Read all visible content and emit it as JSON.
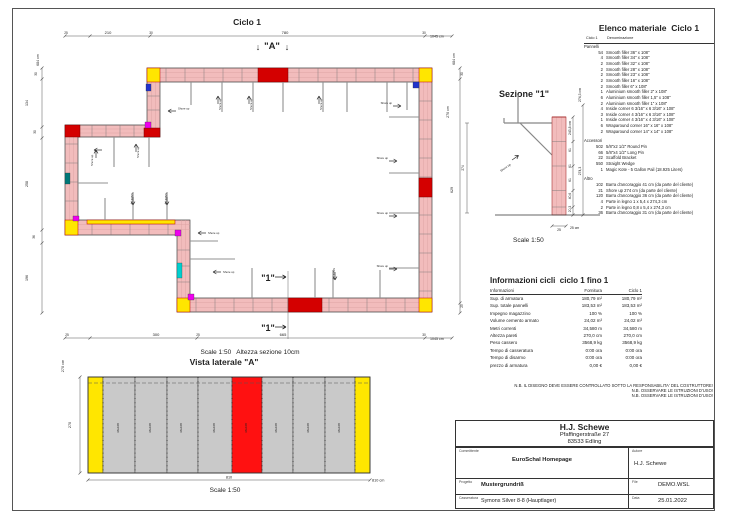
{
  "colors": {
    "wall": "#f2bcbc",
    "yellow": "#ffe600",
    "red": "#d40000",
    "vista_red": "#ff1111",
    "panel_gray": "#c9c9c9",
    "magenta": "#ee00ee",
    "cyan": "#00cfcf",
    "teal": "#007878",
    "blue": "#2233cc"
  },
  "plan": {
    "title": "Ciclo 1",
    "marker_a": "\"A\"",
    "marker_arrow_down": "↓",
    "marker_1": "\"1\"",
    "scale_note": "Scale 1:50   Altezza sezione 10cm",
    "shore_label": "Shore up",
    "dims": {
      "top": {
        "t1": "25",
        "s1": "210",
        "t2": "30",
        "s2": "780",
        "t3": "30",
        "total": "1045 cm"
      },
      "bottom": {
        "t1": "25",
        "s1": "300",
        "t2": "25",
        "s2": "665",
        "t3": "30",
        "total": "1045 cm"
      },
      "left": {
        "total": "684 cm",
        "segs": [
          "30",
          "134",
          "30",
          "258",
          "36",
          "196"
        ]
      },
      "right": {
        "total": "684 cm",
        "s1": "30",
        "s2": "629",
        "s3": "25",
        "aux": "270 cm",
        "aux2": "274"
      }
    }
  },
  "sezione": {
    "title": "Sezione \"1\"",
    "scale": "Scale 1:50",
    "shore_label": "Shore up",
    "dims": {
      "total_inner": "243,8 cm",
      "segs": [
        "61",
        "61",
        "61",
        "40,6",
        "20,3"
      ],
      "outer": "274,3",
      "outer_total": "274,3 cm",
      "base": "25",
      "base_cm": "25 cm"
    }
  },
  "vista": {
    "title": "Vista laterale \"A\"",
    "scale": "Scale 1:50",
    "panel_label": "36x108",
    "dims": {
      "h_total": "270 cm",
      "h": "270",
      "w": "810",
      "w_total": "810 cm"
    }
  },
  "materials": {
    "title": "Elenco materiale  Ciclo 1",
    "col_qty": "Ciclo 1",
    "col_name": "Denominazione",
    "group1": {
      "header": "Pannelli",
      "items": [
        {
          "qty": "54",
          "name": "Smooth filler 36\" x 108\""
        },
        {
          "qty": "4",
          "name": "Smooth filler 34\" x 108\""
        },
        {
          "qty": "2",
          "name": "Smooth filler 32\" x 108\""
        },
        {
          "qty": "2",
          "name": "Smooth filler 28\" x 108\""
        },
        {
          "qty": "2",
          "name": "Smooth filler 23\" x 108\""
        },
        {
          "qty": "2",
          "name": "Smooth filler 16\" x 108\""
        },
        {
          "qty": "2",
          "name": "Smooth filler 6\" x 108\""
        },
        {
          "qty": "1",
          "name": "Aluminium smooth filler 2\" x 108\""
        },
        {
          "qty": "6",
          "name": "Aluminium smooth filler 1,5\" x 108\""
        },
        {
          "qty": "2",
          "name": "Aluminium smooth filler 1\" x 108\""
        },
        {
          "qty": "4",
          "name": "Inside corner 6 3/16\" x 6 3/16\" x 108\""
        },
        {
          "qty": "3",
          "name": "Inside corner 4 3/16\" x 6 3/16\" x 108\""
        },
        {
          "qty": "1",
          "name": "Inside corner 4 3/16\" x 4 3/16\" x 108\""
        },
        {
          "qty": "6",
          "name": "Wraparound corner 16\" x 16\" x 108\""
        },
        {
          "qty": "2",
          "name": "Wraparound corner 14\" x 14\" x 108\""
        }
      ]
    },
    "group2": {
      "header": "Accessori",
      "items": [
        {
          "qty": "502",
          "name": "5/8\"x2 1/2\" Round Pin"
        },
        {
          "qty": "66",
          "name": "5/8\"x4 1/2\" Long Pin"
        },
        {
          "qty": "22",
          "name": "Scaffold Bracket"
        },
        {
          "qty": "550",
          "name": "Straight Wedge"
        },
        {
          "qty": "1",
          "name": "Magic Kote - 5 Gallon Pail (18.925 Liters)"
        }
      ]
    },
    "group3": {
      "header": "Altro",
      "items": [
        {
          "qty": "102",
          "name": "Barra d'ancoraggio 41 cm (da parte del cliente)"
        },
        {
          "qty": "21",
          "name": "Shore up 274 cm (da parte del cliente)"
        },
        {
          "qty": "120",
          "name": "Barra d'ancoraggio 36 cm (da parte del cliente)"
        },
        {
          "qty": "4",
          "name": "Parte in legno 1 x 5,4 x 274,3 cm"
        },
        {
          "qty": "2",
          "name": "Parte in legno 0,8 x 5,4 x 274,3 cm"
        },
        {
          "qty": "36",
          "name": "Barra d'ancoraggio 31 cm (da parte del cliente)"
        }
      ]
    }
  },
  "info": {
    "title": "Informazioni cicli  ciclo 1 fino 1",
    "col_info": "Informazioni",
    "col_forn": "Fornitura",
    "col_ciclo": "Ciclo 1",
    "rows": [
      {
        "label": "Sup. di armatura",
        "fornitura": "180,79 m²",
        "ciclo": "180,79 m²"
      },
      {
        "label": "Sup. totale pannelli",
        "fornitura": "183,53 m²",
        "ciclo": "183,53 m²"
      },
      {
        "label": "Impegno magazzino",
        "fornitura": "100 %",
        "ciclo": "100 %"
      },
      {
        "label": "Volume cemento armato",
        "fornitura": "24,02 m³",
        "ciclo": "24,02 m³"
      },
      {
        "label": "Metri correnti",
        "fornitura": "34,580 m",
        "ciclo": "34,580 m"
      },
      {
        "label": "Altezza pareti",
        "fornitura": "270,0 cm",
        "ciclo": "270,0 cm"
      },
      {
        "label": "Peso cassero",
        "fornitura": "3568,9 kg",
        "ciclo": "3568,9 kg"
      },
      {
        "label": "Tempo di casseratura",
        "fornitura": "0:00 ora",
        "ciclo": "0:00 ora"
      },
      {
        "label": "Tempo di disarmo",
        "fornitura": "0:00 ora",
        "ciclo": "0:00 ora"
      },
      {
        "label": "prezzo di armatura",
        "fornitura": "0,00 €",
        "ciclo": "0,00 €"
      }
    ]
  },
  "notes": [
    "N.B. IL DISEGNO DEVE ESSERE CONTROLLATO SOTTO LA RESPONSABILITA' DEL COSTRUTTORE!",
    "N.B. OSSERVARE LE ISTRUZIONI D'USO!",
    "N.B. OSSERVARE LE ISTRUZIONI D'USO!"
  ],
  "titleblock": {
    "company": "H.J. Schewe",
    "address1": "Pfaffingerstraße 27",
    "address2": "83533 Edling",
    "committente_label": "Committente",
    "committente": "EuroSchal Homepage",
    "autore_label": "Autore",
    "autore": "H.J. Schewe",
    "progetto_label": "Progetto",
    "progetto": "Mustergrundriß",
    "file_label": "File",
    "file": "DEMO.WSL",
    "casseratura_label": "Casseratura",
    "casseratura": "Symons Silver 8-8 (Hauptlager)",
    "data_label": "Data",
    "data": "25.01.2022"
  }
}
